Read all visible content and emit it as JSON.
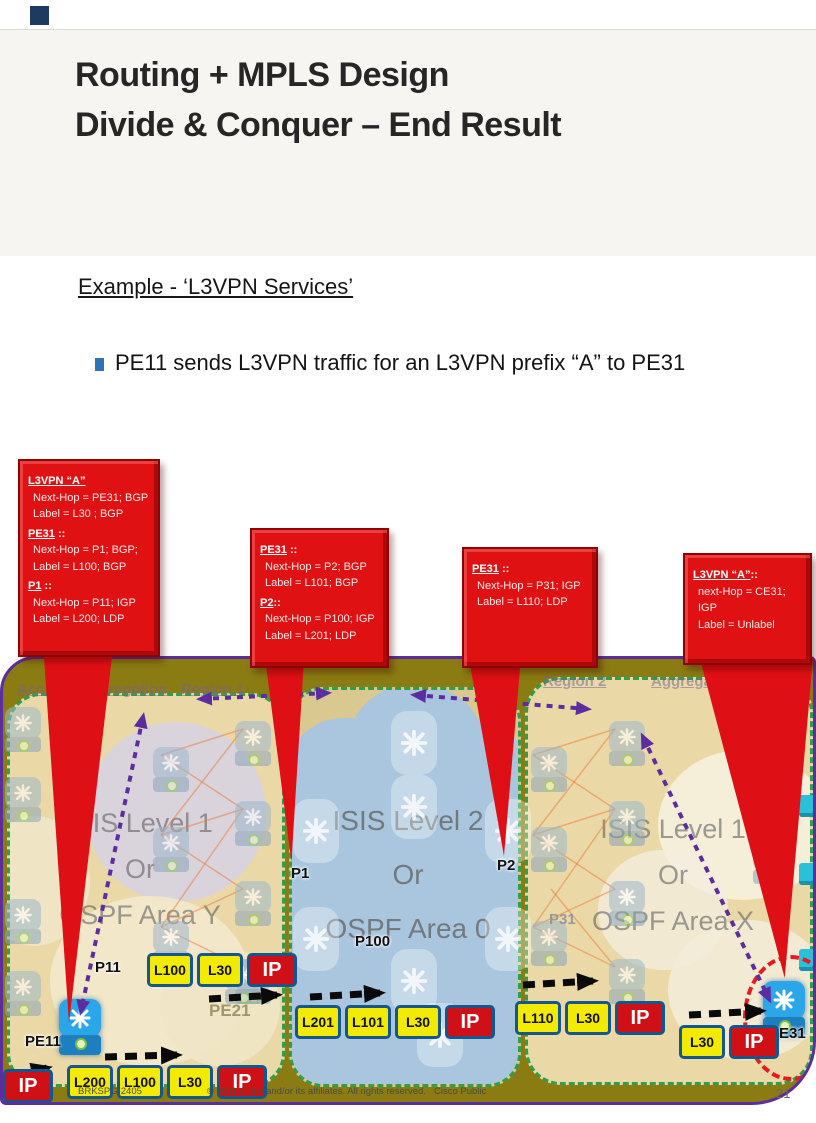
{
  "header": {
    "title_line1": "Routing + MPLS Design",
    "title_line2": "Divide & Conquer – End Result"
  },
  "body": {
    "example_heading": "Example - ‘L3VPN Services’",
    "bullet_text": "PE11 sends L3VPN traffic for an L3VPN prefix “A” to PE31"
  },
  "callouts": {
    "c1": {
      "sections": [
        {
          "head": "L3VPN “A”",
          "rest": "",
          "lines": [
            "Next-Hop = PE31; BGP",
            "Label = L30 ; BGP"
          ]
        },
        {
          "head": "PE31",
          "rest": " ::",
          "lines": [
            "Next-Hop = P1; BGP;",
            "Label = L100; BGP"
          ]
        },
        {
          "head": "P1",
          "rest": " ::",
          "lines": [
            "Next-Hop = P11; IGP",
            "Label = L200; LDP"
          ]
        }
      ]
    },
    "c2": {
      "sections": [
        {
          "head": "PE31",
          "rest": " ::",
          "lines": [
            "Next-Hop = P2; BGP",
            "Label = L101; BGP"
          ]
        },
        {
          "head": "P2",
          "rest": "::",
          "lines": [
            "Next-Hop = P100; IGP",
            "Label = L201; LDP"
          ]
        }
      ]
    },
    "c3": {
      "sections": [
        {
          "head": "PE31",
          "rest": " ::",
          "lines": [
            "Next-Hop = P31; IGP",
            "Label = L110; LDP"
          ]
        }
      ]
    },
    "c4": {
      "sections": [
        {
          "head": "L3VPN “A”",
          "rest": "::",
          "lines": [
            "next-Hop = CE31; IGP",
            "Label = Unlabel"
          ]
        }
      ]
    }
  },
  "regions": {
    "left": {
      "zones": [
        "Access",
        "Aggregation",
        "Region 1"
      ],
      "igp": [
        "ISIS Level 1",
        "Or",
        "OSPF Area Y"
      ]
    },
    "core": {
      "igp": [
        "ISIS Level 2",
        "Or",
        "OSPF Area 0"
      ]
    },
    "right": {
      "zones": [
        "Region 2",
        "Aggregation",
        "Access"
      ],
      "igp": [
        "ISIS Level 1",
        "Or",
        "OSPF Area X"
      ]
    }
  },
  "nodes": {
    "pe11": "PE11",
    "p11": "P11",
    "pe21": "PE21",
    "p1": "P1",
    "p100": "P100",
    "p2": "P2",
    "p31": "P31",
    "pe31": "PE31"
  },
  "stacks": {
    "lone_ip": [
      "IP"
    ],
    "pe11": [
      "L200",
      "L100",
      "L30",
      "IP"
    ],
    "p11": [
      "L100",
      "L30",
      "IP"
    ],
    "core": [
      "L201",
      "L101",
      "L30",
      "IP"
    ],
    "region2": [
      "L110",
      "L30",
      "IP"
    ],
    "pe31": [
      "L30",
      "IP"
    ]
  },
  "footer": {
    "session": "BRKSPG-2405",
    "copyright": "© 2011 Cisco and/or its affiliates. All rights reserved.",
    "classification": "Cisco Public",
    "page": "21"
  },
  "colors": {
    "callout_red": "#e01112",
    "label_yellow": "#f2ea00",
    "label_ip_red": "#cf1016",
    "diagram_olive": "#8a7b12",
    "core_blue": "#a9c6de",
    "region_tan": "#ead9a6",
    "border_purple": "#5b2d9e",
    "region_border_green": "#2f9e4f",
    "bullet_blue": "#2e74b5"
  }
}
